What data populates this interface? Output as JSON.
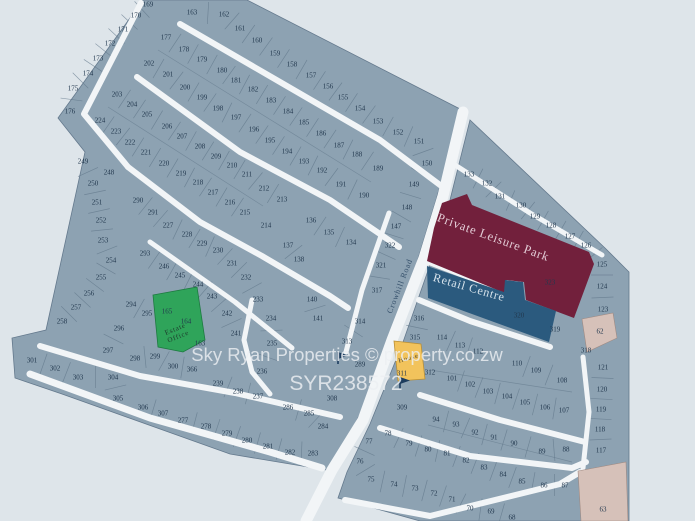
{
  "map": {
    "background": "#dee5ea",
    "land_fill": "#8da2b2",
    "land_stroke": "#64798d",
    "road_color": "#f2f5f7",
    "number_color": "#22384e",
    "watermark": {
      "line1": "Sky Ryan Properties  ©  property.co.zw",
      "line2": "SYR238572",
      "color": "#edf0f3"
    },
    "road_label": "Crowhill Road",
    "areas": {
      "private_leisure_park": {
        "label": "Private Leisure Park",
        "number": "323",
        "color": "#72203c",
        "text_color": "#e3ccd6"
      },
      "retail_centre": {
        "label": "Retail Centre",
        "number": "320",
        "color": "#2b5a7e",
        "text_color": "#d8e4ec"
      },
      "estate_office": {
        "label_line1": "Estate",
        "label_line2": "Office",
        "numbers": [
          "165",
          "164"
        ],
        "color": "#2fa45a",
        "text_color": "#1d3a2c"
      },
      "house_plot": {
        "label": "House",
        "number": "311",
        "color": "#f2c35c",
        "text_color": "#4a4430"
      },
      "tan_plot_62": {
        "number": "62",
        "color": "#d6c1b9"
      },
      "tan_plot_63": {
        "number": "63",
        "color": "#d6c1b9"
      }
    },
    "plots": [
      [
        "169",
        148,
        4
      ],
      [
        "170",
        136,
        15
      ],
      [
        "171",
        123,
        29
      ],
      [
        "172",
        110,
        43
      ],
      [
        "173",
        98,
        58
      ],
      [
        "174",
        88,
        73
      ],
      [
        "175",
        73,
        88
      ],
      [
        "176",
        70,
        111
      ],
      [
        "163",
        192,
        12
      ],
      [
        "162",
        224,
        14
      ],
      [
        "161",
        240,
        28
      ],
      [
        "160",
        257,
        40
      ],
      [
        "159",
        275,
        53
      ],
      [
        "158",
        292,
        64
      ],
      [
        "157",
        311,
        75
      ],
      [
        "156",
        328,
        86
      ],
      [
        "155",
        343,
        97
      ],
      [
        "154",
        360,
        108
      ],
      [
        "153",
        378,
        121
      ],
      [
        "152",
        398,
        132
      ],
      [
        "151",
        419,
        141
      ],
      [
        "150",
        427,
        163
      ],
      [
        "149",
        414,
        184
      ],
      [
        "148",
        407,
        207
      ],
      [
        "147",
        396,
        226
      ],
      [
        "322",
        390,
        245
      ],
      [
        "321",
        381,
        265
      ],
      [
        "317",
        377,
        290
      ],
      [
        "177",
        166,
        37
      ],
      [
        "178",
        184,
        49
      ],
      [
        "179",
        202,
        59
      ],
      [
        "180",
        222,
        70
      ],
      [
        "181",
        236,
        80
      ],
      [
        "182",
        253,
        89
      ],
      [
        "183",
        271,
        100
      ],
      [
        "184",
        288,
        111
      ],
      [
        "185",
        304,
        122
      ],
      [
        "186",
        321,
        133
      ],
      [
        "187",
        339,
        145
      ],
      [
        "188",
        357,
        154
      ],
      [
        "189",
        378,
        168
      ],
      [
        "202",
        149,
        63
      ],
      [
        "201",
        168,
        74
      ],
      [
        "200",
        185,
        87
      ],
      [
        "199",
        202,
        97
      ],
      [
        "198",
        218,
        108
      ],
      [
        "197",
        236,
        117
      ],
      [
        "196",
        254,
        129
      ],
      [
        "195",
        270,
        140
      ],
      [
        "194",
        287,
        151
      ],
      [
        "193",
        304,
        161
      ],
      [
        "192",
        322,
        170
      ],
      [
        "191",
        341,
        184
      ],
      [
        "190",
        364,
        195
      ],
      [
        "203",
        117,
        94
      ],
      [
        "204",
        132,
        104
      ],
      [
        "205",
        147,
        114
      ],
      [
        "206",
        167,
        126
      ],
      [
        "207",
        182,
        136
      ],
      [
        "208",
        200,
        146
      ],
      [
        "209",
        216,
        156
      ],
      [
        "210",
        232,
        165
      ],
      [
        "211",
        247,
        174
      ],
      [
        "212",
        264,
        188
      ],
      [
        "213",
        282,
        199
      ],
      [
        "214",
        266,
        225
      ],
      [
        "224",
        100,
        120
      ],
      [
        "223",
        116,
        131
      ],
      [
        "222",
        130,
        142
      ],
      [
        "221",
        146,
        152
      ],
      [
        "220",
        164,
        163
      ],
      [
        "219",
        181,
        173
      ],
      [
        "218",
        198,
        182
      ],
      [
        "217",
        213,
        192
      ],
      [
        "216",
        230,
        202
      ],
      [
        "215",
        245,
        212
      ],
      [
        "249",
        83,
        161
      ],
      [
        "248",
        109,
        172
      ],
      [
        "250",
        93,
        183
      ],
      [
        "251",
        97,
        202
      ],
      [
        "252",
        101,
        220
      ],
      [
        "253",
        103,
        240
      ],
      [
        "254",
        111,
        260
      ],
      [
        "255",
        101,
        277
      ],
      [
        "256",
        89,
        293
      ],
      [
        "257",
        76,
        307
      ],
      [
        "258",
        62,
        321
      ],
      [
        "290",
        138,
        200
      ],
      [
        "291",
        153,
        212
      ],
      [
        "227",
        168,
        225
      ],
      [
        "228",
        187,
        234
      ],
      [
        "229",
        202,
        243
      ],
      [
        "230",
        218,
        250
      ],
      [
        "231",
        232,
        263
      ],
      [
        "232",
        246,
        277
      ],
      [
        "233",
        258,
        299
      ],
      [
        "293",
        145,
        253
      ],
      [
        "246",
        164,
        266
      ],
      [
        "245",
        180,
        275
      ],
      [
        "244",
        198,
        284
      ],
      [
        "243",
        212,
        296
      ],
      [
        "242",
        227,
        313
      ],
      [
        "241",
        236,
        333
      ],
      [
        "234",
        271,
        318
      ],
      [
        "235",
        272,
        343
      ],
      [
        "236",
        262,
        371
      ],
      [
        "237",
        258,
        396
      ],
      [
        "238",
        238,
        391
      ],
      [
        "239",
        218,
        383
      ],
      [
        "294",
        131,
        304
      ],
      [
        "295",
        147,
        313
      ],
      [
        "296",
        119,
        328
      ],
      [
        "297",
        108,
        350
      ],
      [
        "298",
        135,
        358
      ],
      [
        "299",
        155,
        356
      ],
      [
        "300",
        173,
        366
      ],
      [
        "366",
        192,
        369
      ],
      [
        "163",
        200,
        343
      ],
      [
        "301",
        32,
        360
      ],
      [
        "302",
        55,
        368
      ],
      [
        "303",
        78,
        377
      ],
      [
        "304",
        113,
        377
      ],
      [
        "305",
        118,
        398
      ],
      [
        "306",
        143,
        407
      ],
      [
        "307",
        163,
        413
      ],
      [
        "277",
        183,
        420
      ],
      [
        "278",
        206,
        426
      ],
      [
        "279",
        227,
        433
      ],
      [
        "280",
        247,
        440
      ],
      [
        "281",
        268,
        446
      ],
      [
        "282",
        290,
        452
      ],
      [
        "283",
        313,
        453
      ],
      [
        "284",
        323,
        426
      ],
      [
        "285",
        309,
        413
      ],
      [
        "286",
        288,
        407
      ],
      [
        "308",
        332,
        398
      ],
      [
        "136",
        311,
        220
      ],
      [
        "135",
        329,
        232
      ],
      [
        "134",
        351,
        242
      ],
      [
        "137",
        288,
        245
      ],
      [
        "138",
        299,
        259
      ],
      [
        "140",
        312,
        299
      ],
      [
        "141",
        318,
        318
      ],
      [
        "314",
        360,
        321
      ],
      [
        "313",
        347,
        341
      ],
      [
        "289",
        360,
        364
      ],
      [
        "133",
        469,
        174
      ],
      [
        "132",
        487,
        183
      ],
      [
        "131",
        500,
        196
      ],
      [
        "130",
        521,
        205
      ],
      [
        "129",
        535,
        216
      ],
      [
        "128",
        551,
        225
      ],
      [
        "127",
        570,
        236
      ],
      [
        "126",
        586,
        245
      ],
      [
        "125",
        602,
        264
      ],
      [
        "124",
        602,
        286
      ],
      [
        "123",
        603,
        309
      ],
      [
        "318",
        586,
        350
      ],
      [
        "121",
        603,
        367
      ],
      [
        "120",
        602,
        389
      ],
      [
        "119",
        601,
        409
      ],
      [
        "118",
        600,
        429
      ],
      [
        "117",
        601,
        450
      ],
      [
        "319",
        555,
        329
      ],
      [
        "316",
        419,
        318
      ],
      [
        "315",
        415,
        337
      ],
      [
        "312",
        430,
        372
      ],
      [
        "114",
        442,
        337
      ],
      [
        "113",
        460,
        345
      ],
      [
        "112",
        478,
        351
      ],
      [
        "110",
        517,
        363
      ],
      [
        "109",
        536,
        370
      ],
      [
        "108",
        562,
        380
      ],
      [
        "101",
        452,
        378
      ],
      [
        "102",
        470,
        384
      ],
      [
        "103",
        488,
        391
      ],
      [
        "104",
        507,
        396
      ],
      [
        "105",
        525,
        402
      ],
      [
        "106",
        545,
        407
      ],
      [
        "107",
        564,
        410
      ],
      [
        "309",
        402,
        407
      ],
      [
        "94",
        436,
        419
      ],
      [
        "93",
        456,
        424
      ],
      [
        "92",
        475,
        432
      ],
      [
        "91",
        494,
        437
      ],
      [
        "90",
        514,
        443
      ],
      [
        "89",
        542,
        451
      ],
      [
        "88",
        566,
        449
      ],
      [
        "78",
        388,
        433
      ],
      [
        "79",
        409,
        443
      ],
      [
        "80",
        428,
        449
      ],
      [
        "81",
        447,
        453
      ],
      [
        "82",
        466,
        460
      ],
      [
        "83",
        484,
        467
      ],
      [
        "84",
        503,
        474
      ],
      [
        "85",
        522,
        481
      ],
      [
        "86",
        544,
        485
      ],
      [
        "87",
        565,
        485
      ],
      [
        "77",
        369,
        441
      ],
      [
        "76",
        360,
        461
      ],
      [
        "75",
        371,
        479
      ],
      [
        "74",
        394,
        484
      ],
      [
        "73",
        415,
        488
      ],
      [
        "72",
        434,
        493
      ],
      [
        "71",
        452,
        499
      ],
      [
        "70",
        470,
        508
      ],
      [
        "69",
        491,
        511
      ],
      [
        "68",
        512,
        517
      ]
    ],
    "special_numbers": {
      "323": [
        550,
        282
      ],
      "320": [
        519,
        315
      ],
      "165": [
        167,
        311
      ],
      "164": [
        186,
        321
      ],
      "311": [
        402,
        373
      ],
      "62": [
        600,
        331
      ],
      "63": [
        603,
        509
      ]
    }
  }
}
